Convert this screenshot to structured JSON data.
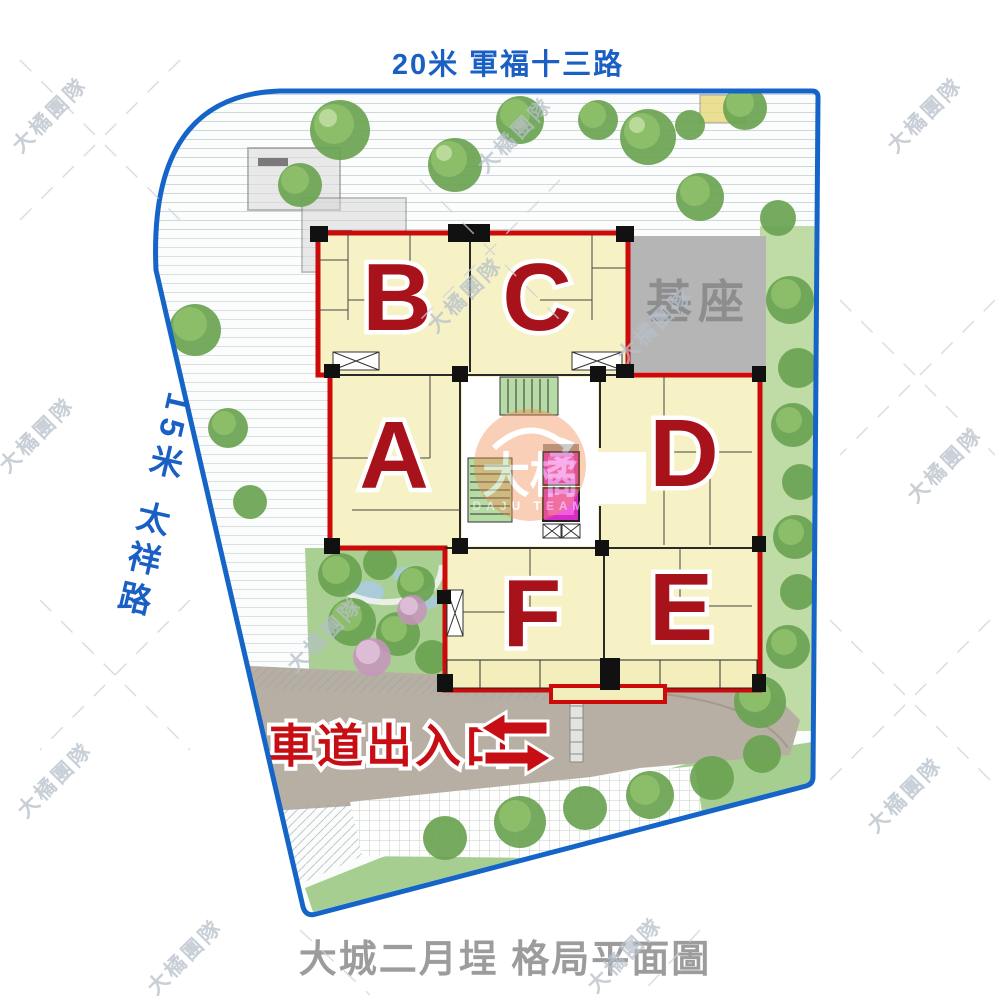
{
  "page": {
    "title_top": "20米 軍福十三路",
    "road_left": "15米 太祥路",
    "footer_title": "大城二月埕 格局平面圖"
  },
  "plan": {
    "base_label": "基座",
    "driveway_label": "車道出入口",
    "units": {
      "a": "A",
      "b": "B",
      "c": "C",
      "d": "D",
      "e": "E",
      "f": "F"
    }
  },
  "watermark": {
    "text": "大橘團隊",
    "logo_cn": "大橘",
    "logo_en": "DAJU TEAM"
  },
  "colors": {
    "road_text_blue": "#1a5fc4",
    "site_border_blue": "#1565c8",
    "building_outline_red": "#cc0a0a",
    "unit_letter_red": "#a8121b",
    "driveway_text_red": "#c60e14",
    "room_fill": "#f6f2c5",
    "base_gray": "#b5b5b5",
    "base_text_gray": "#8d8d8d",
    "footer_gray": "#9c9c9c",
    "stair_green": "#b7dba4",
    "elevator_pink": "#d92bc8",
    "logo_orange": "#f08a4e"
  }
}
